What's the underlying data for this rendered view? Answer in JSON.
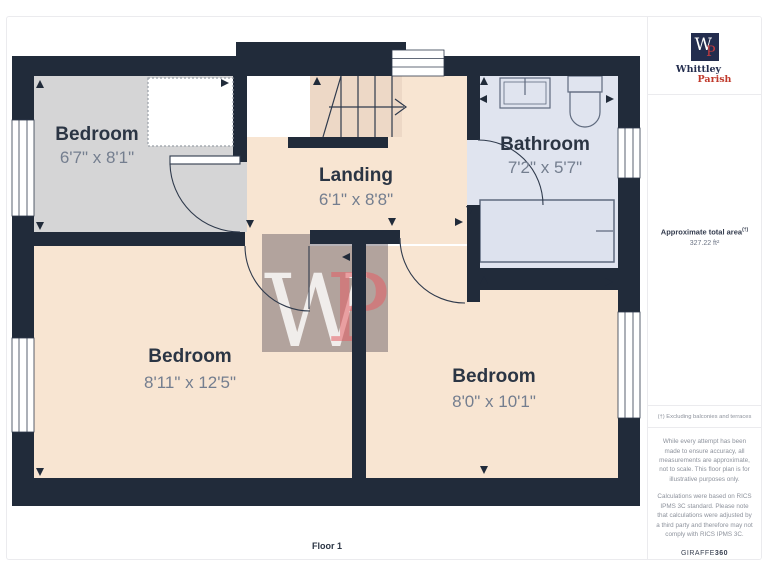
{
  "branding": {
    "logo_letter_w": "W",
    "logo_letter_p": "P",
    "brand_line1": "Whittley",
    "brand_line2": "Parish"
  },
  "sidebar": {
    "area_label": "Approximate total area",
    "area_superscript": "(†)",
    "area_value": "327.22 ft²",
    "footnote": "(†) Excluding balconies and terraces",
    "disclaimer1": "While every attempt has been made to ensure accuracy, all measurements are approximate, not to scale. This floor plan is for illustrative purposes only.",
    "disclaimer2": "Calculations were based on RICS IPMS 3C standard. Please note that calculations were adjusted by a third party and therefore may not comply with RICS IPMS 3C.",
    "provider": "GIRAFFE",
    "provider_suffix": "360"
  },
  "floor_label": "Floor 1",
  "watermark": {
    "w": "W",
    "p": "P"
  },
  "rooms": {
    "bedroom_tl": {
      "label": "Bedroom",
      "dims": "6'7\" x 8'1\""
    },
    "landing": {
      "label": "Landing",
      "dims": "6'1\" x 8'8\""
    },
    "bathroom": {
      "label": "Bathroom",
      "dims": "7'2\" x 5'7\""
    },
    "bedroom_bl": {
      "label": "Bedroom",
      "dims": "8'11\" x 12'5\""
    },
    "bedroom_br": {
      "label": "Bedroom",
      "dims": "8'0\" x 10'1\""
    }
  },
  "colors": {
    "wall": "#212b3a",
    "room_gray": "#d5d5d6",
    "room_peach": "#f8e5d2",
    "stairs_peach": "#edd8c6",
    "room_blue": "#e0e4ef",
    "accent_red": "#c0392b",
    "navy": "#232d4e"
  }
}
